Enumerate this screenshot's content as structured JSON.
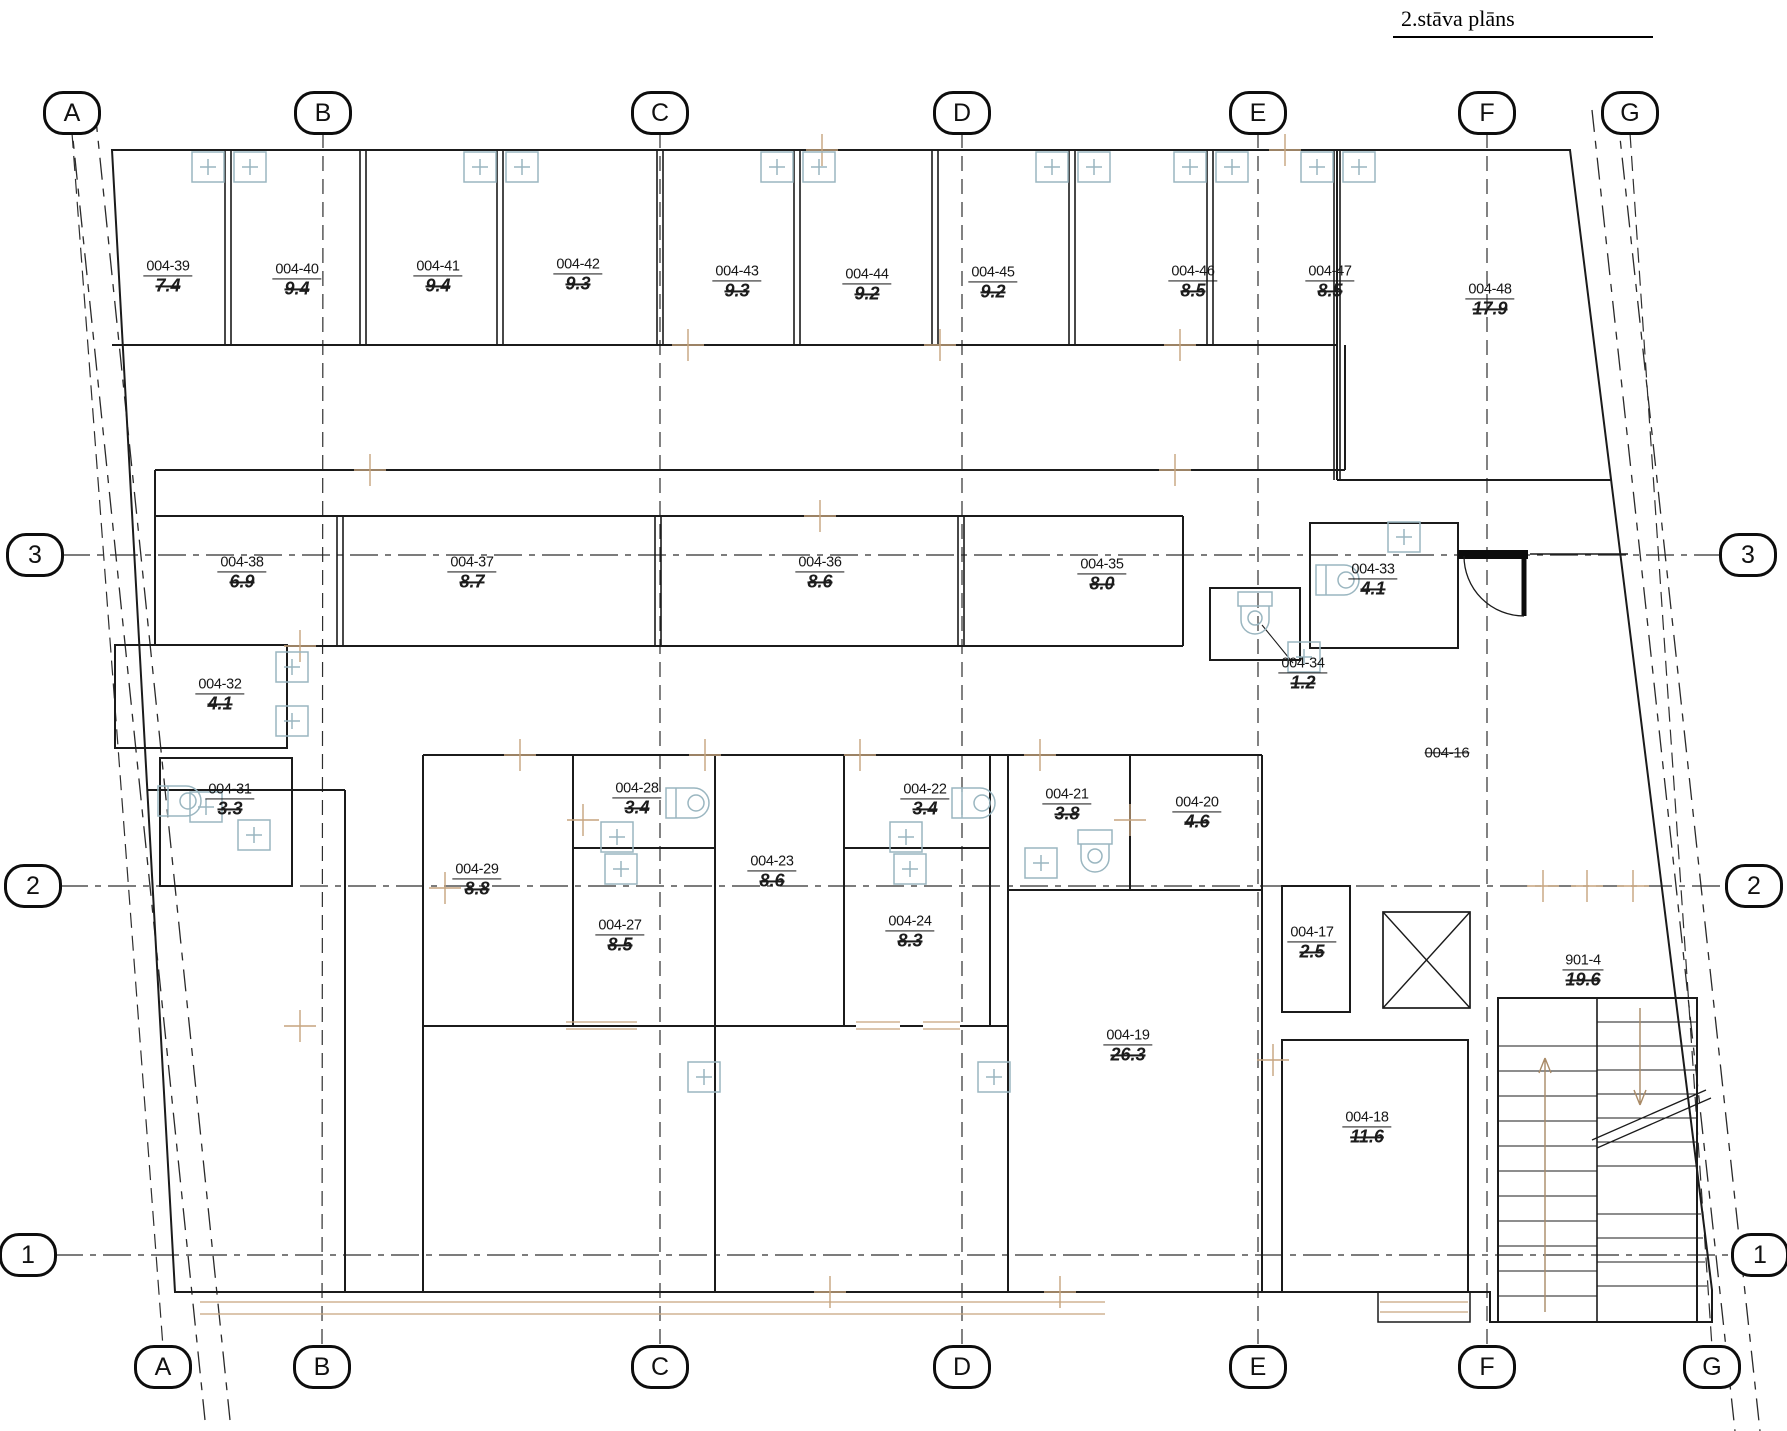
{
  "title": "2.stāva plāns",
  "grid": {
    "columns": [
      {
        "label": "A",
        "x_top": 72,
        "x_bottom": 163
      },
      {
        "label": "B",
        "x_top": 323,
        "x_bottom": 322
      },
      {
        "label": "C",
        "x_top": 660,
        "x_bottom": 660
      },
      {
        "label": "D",
        "x_top": 962,
        "x_bottom": 962
      },
      {
        "label": "E",
        "x_top": 1258,
        "x_bottom": 1258
      },
      {
        "label": "F",
        "x_top": 1487,
        "x_bottom": 1487
      },
      {
        "label": "G",
        "x_top": 1630,
        "x_bottom": 1712
      }
    ],
    "rows": [
      {
        "label": "3",
        "y": 555,
        "x_left": 35,
        "x_right": 1748
      },
      {
        "label": "2",
        "y": 886,
        "x_left": 33,
        "x_right": 1754
      },
      {
        "label": "1",
        "y": 1255,
        "x_left": 28,
        "x_right": 1760
      }
    ]
  },
  "rooms": [
    {
      "id": "004-39",
      "area": "7.4",
      "x": 168,
      "y": 277
    },
    {
      "id": "004-40",
      "area": "9.4",
      "x": 297,
      "y": 280
    },
    {
      "id": "004-41",
      "area": "9.4",
      "x": 438,
      "y": 277
    },
    {
      "id": "004-42",
      "area": "9.3",
      "x": 578,
      "y": 275
    },
    {
      "id": "004-43",
      "area": "9.3",
      "x": 737,
      "y": 282
    },
    {
      "id": "004-44",
      "area": "9.2",
      "x": 867,
      "y": 285
    },
    {
      "id": "004-45",
      "area": "9.2",
      "x": 993,
      "y": 283
    },
    {
      "id": "004-46",
      "area": "8.5",
      "x": 1193,
      "y": 282
    },
    {
      "id": "004-47",
      "area": "8.5",
      "x": 1330,
      "y": 282
    },
    {
      "id": "004-48",
      "area": "17.9",
      "x": 1490,
      "y": 300
    },
    {
      "id": "004-38",
      "area": "6.9",
      "x": 242,
      "y": 573
    },
    {
      "id": "004-37",
      "area": "8.7",
      "x": 472,
      "y": 573
    },
    {
      "id": "004-36",
      "area": "8.6",
      "x": 820,
      "y": 573
    },
    {
      "id": "004-35",
      "area": "8.0",
      "x": 1102,
      "y": 575
    },
    {
      "id": "004-34",
      "area": "1.2",
      "x": 1303,
      "y": 674
    },
    {
      "id": "004-33",
      "area": "4.1",
      "x": 1373,
      "y": 580
    },
    {
      "id": "004-32",
      "area": "4.1",
      "x": 220,
      "y": 695
    },
    {
      "id": "004-31",
      "area": "3.3",
      "x": 230,
      "y": 800
    },
    {
      "id": "004-29",
      "area": "8.8",
      "x": 477,
      "y": 880
    },
    {
      "id": "004-28",
      "area": "3.4",
      "x": 637,
      "y": 799
    },
    {
      "id": "004-27",
      "area": "8.5",
      "x": 620,
      "y": 936
    },
    {
      "id": "004-23",
      "area": "8.6",
      "x": 772,
      "y": 872
    },
    {
      "id": "004-22",
      "area": "3.4",
      "x": 925,
      "y": 800
    },
    {
      "id": "004-24",
      "area": "8.3",
      "x": 910,
      "y": 932
    },
    {
      "id": "004-21",
      "area": "3.8",
      "x": 1067,
      "y": 805
    },
    {
      "id": "004-20",
      "area": "4.6",
      "x": 1197,
      "y": 813
    },
    {
      "id": "004-19",
      "area": "26.3",
      "x": 1128,
      "y": 1046
    },
    {
      "id": "004-17",
      "area": "2.5",
      "x": 1312,
      "y": 943
    },
    {
      "id": "004-18",
      "area": "11.6",
      "x": 1367,
      "y": 1128
    },
    {
      "id": "004-16",
      "area": "",
      "x": 1447,
      "y": 753
    },
    {
      "id": "901-4",
      "area": "19.6",
      "x": 1583,
      "y": 971
    }
  ],
  "fixtures": {
    "radiators": [
      [
        192,
        152
      ],
      [
        234,
        152
      ],
      [
        464,
        152
      ],
      [
        506,
        152
      ],
      [
        761,
        152
      ],
      [
        803,
        152
      ],
      [
        1036,
        152
      ],
      [
        1078,
        152
      ],
      [
        1174,
        152
      ],
      [
        1216,
        152
      ],
      [
        1301,
        152
      ],
      [
        1343,
        152
      ],
      [
        190,
        792
      ],
      [
        238,
        820
      ],
      [
        601,
        822
      ],
      [
        605,
        854
      ],
      [
        890,
        822
      ],
      [
        894,
        854
      ],
      [
        1025,
        848
      ],
      [
        688,
        1062
      ],
      [
        978,
        1062
      ],
      [
        1288,
        642
      ],
      [
        1388,
        522
      ],
      [
        276,
        652
      ],
      [
        276,
        706
      ]
    ],
    "boilers": [
      [
        158,
        786
      ],
      [
        666,
        788
      ],
      [
        952,
        788
      ],
      [
        1316,
        565
      ]
    ],
    "toilets": [
      [
        1238,
        592
      ],
      [
        1078,
        830
      ]
    ]
  },
  "colors": {
    "wall": "#1b1b1b",
    "grid_line": "#2e2e2e",
    "fixture_blue": "#9ab6c0",
    "dim_tan": "#c6a47e"
  }
}
